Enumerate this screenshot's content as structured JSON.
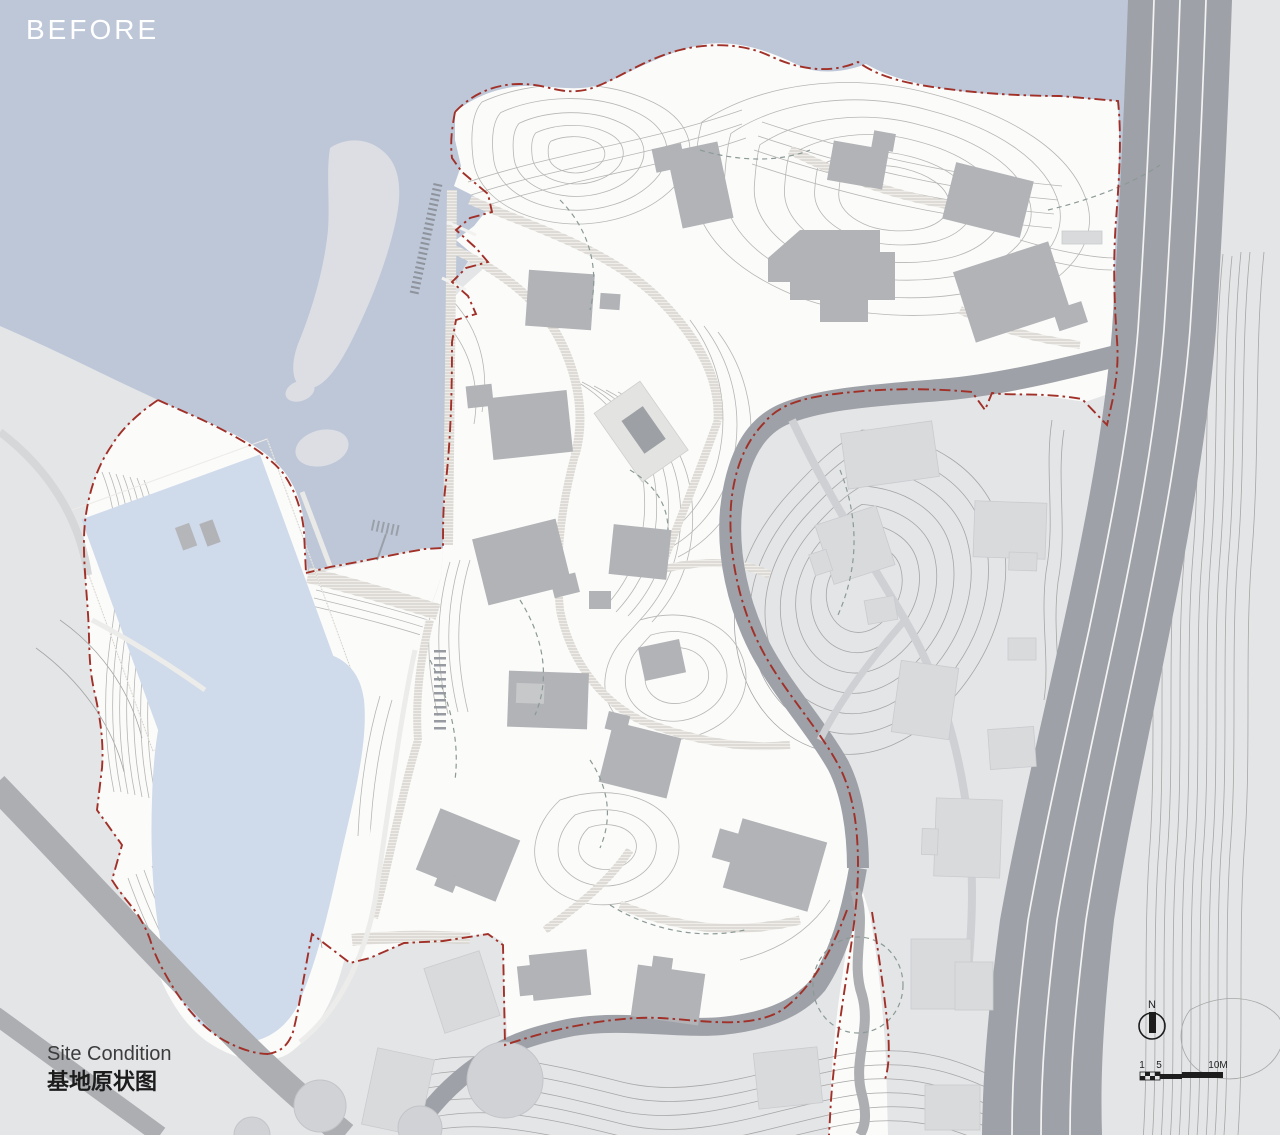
{
  "header": {
    "phase_label": "BEFORE"
  },
  "caption": {
    "title_en": "Site Condition",
    "title_zh": "基地原状图"
  },
  "compass": {
    "icon": "north-arrow-icon",
    "north_label": "N"
  },
  "scale_bar": {
    "icon": "scale-bar",
    "tick_1": "1",
    "tick_5": "5",
    "tick_10": "10M"
  },
  "palette": {
    "sea": "#bdc7d8",
    "pond": "#cfdaea",
    "island": "#dcdee3",
    "land_context": "#e4e5e7",
    "site": "#fbfbfa",
    "building_site": "#b1b3b6",
    "building_context": "#d8dadc",
    "road": "#9ea1a7",
    "road_minor": "#acaeb2",
    "lane_line": "#f3f3f3",
    "boundary_red": "#a03028",
    "contour": "#b6b6b4",
    "contour_dark": "#a6a6a6",
    "hatch": "#cfccc4",
    "drainage_dash": "#8b9a96",
    "text_dark": "#3c3c3c",
    "text_light": "#ffffff"
  }
}
